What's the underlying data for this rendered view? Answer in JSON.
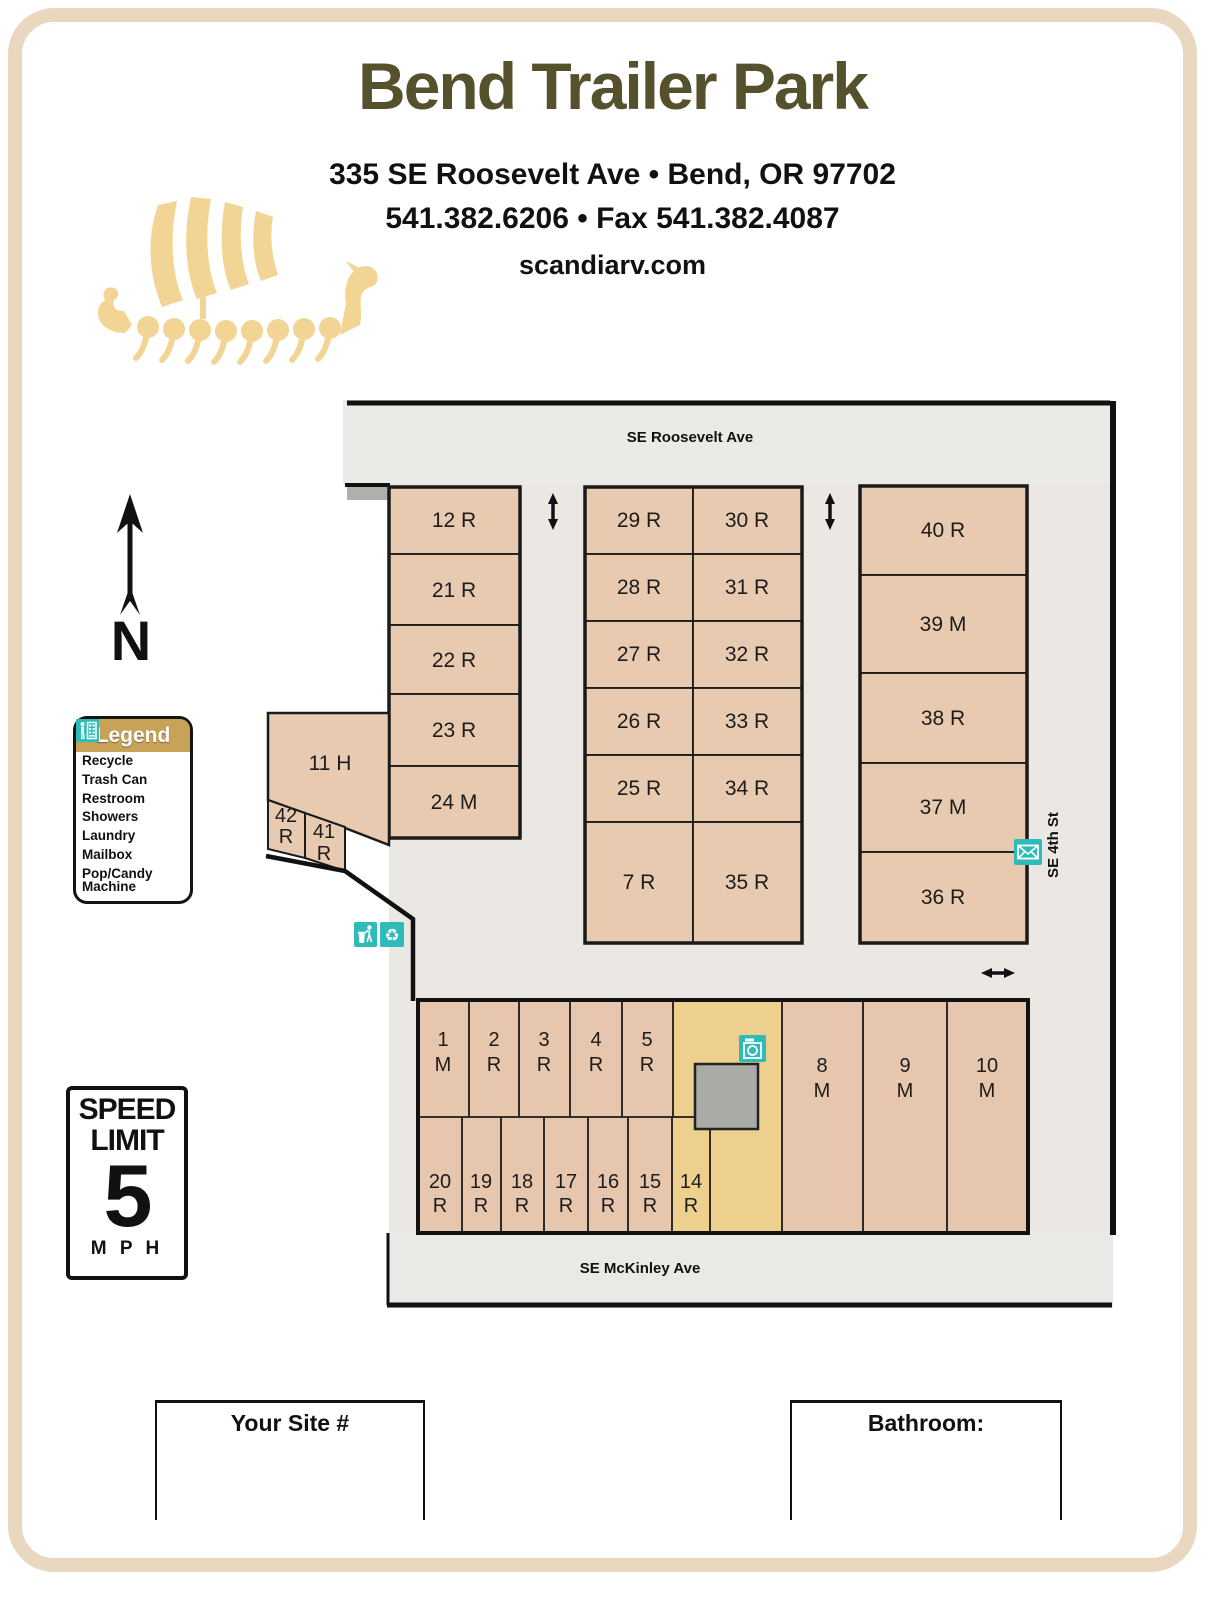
{
  "header": {
    "title": "Bend Trailer Park",
    "address": "335 SE Roosevelt Ave • Bend, OR 97702",
    "phone_fax": "541.382.6206 • Fax 541.382.4087",
    "website": "scandiarv.com"
  },
  "compass": {
    "label": "N"
  },
  "legend": {
    "title": "Legend",
    "items": [
      {
        "icon": "recycle-icon",
        "label": "Recycle",
        "glyph": "♻"
      },
      {
        "icon": "trash-can-icon",
        "label": "Trash Can"
      },
      {
        "icon": "restroom-icon",
        "label": "Restroom"
      },
      {
        "icon": "showers-icon",
        "label": "Showers"
      },
      {
        "icon": "laundry-icon",
        "label": "Laundry"
      },
      {
        "icon": "mailbox-icon",
        "label": "Mailbox"
      },
      {
        "icon": "vending-machine-icon",
        "label": "Pop/Candy Machine",
        "label_line1": "Pop/Candy",
        "label_line2": "Machine"
      }
    ]
  },
  "speed_sign": {
    "line1": "SPEED",
    "line2": "LIMIT",
    "value": "5",
    "unit": "M P H"
  },
  "map": {
    "streets": {
      "top": "SE Roosevelt Ave",
      "right": "SE 4th St",
      "bottom": "SE McKinley Ave"
    },
    "lots": {
      "left_column": [
        "12 R",
        "21 R",
        "22 R",
        "23 R",
        "24 M"
      ],
      "hill_lot": "11 H",
      "small_lots": [
        {
          "num": "42",
          "letter": "R"
        },
        {
          "num": "41",
          "letter": "R"
        }
      ],
      "center_left": [
        "29 R",
        "28 R",
        "27 R",
        "26 R",
        "25 R",
        "7 R"
      ],
      "center_right": [
        "30 R",
        "31 R",
        "32 R",
        "33 R",
        "34 R",
        "35 R"
      ],
      "east_column": [
        "40 R",
        "39 M",
        "38 R",
        "37 M",
        "36 R"
      ],
      "south_top_row": [
        {
          "num": "1",
          "letter": "M"
        },
        {
          "num": "2",
          "letter": "R"
        },
        {
          "num": "3",
          "letter": "R"
        },
        {
          "num": "4",
          "letter": "R"
        },
        {
          "num": "5",
          "letter": "R"
        }
      ],
      "south_bottom_row": [
        {
          "num": "20",
          "letter": "R"
        },
        {
          "num": "19",
          "letter": "R"
        },
        {
          "num": "18",
          "letter": "R"
        },
        {
          "num": "17",
          "letter": "R"
        },
        {
          "num": "16",
          "letter": "R"
        },
        {
          "num": "15",
          "letter": "R"
        },
        {
          "num": "14",
          "letter": "R"
        }
      ],
      "south_tall": [
        {
          "num": "8",
          "letter": "M"
        },
        {
          "num": "9",
          "letter": "M"
        },
        {
          "num": "10",
          "letter": "M"
        }
      ]
    }
  },
  "footer": {
    "site_box_label": "Your Site #",
    "bathroom_box_label": "Bathroom:"
  },
  "colors": {
    "accent_teal": "#2fbcb8",
    "lot_tan": "#e8cab0",
    "laundry_yellow": "#eed08e",
    "legend_gold": "#c7a257",
    "title_olive": "#55512d",
    "ship_gold": "#f2d594",
    "page_border_tan": "#ead7c0"
  }
}
